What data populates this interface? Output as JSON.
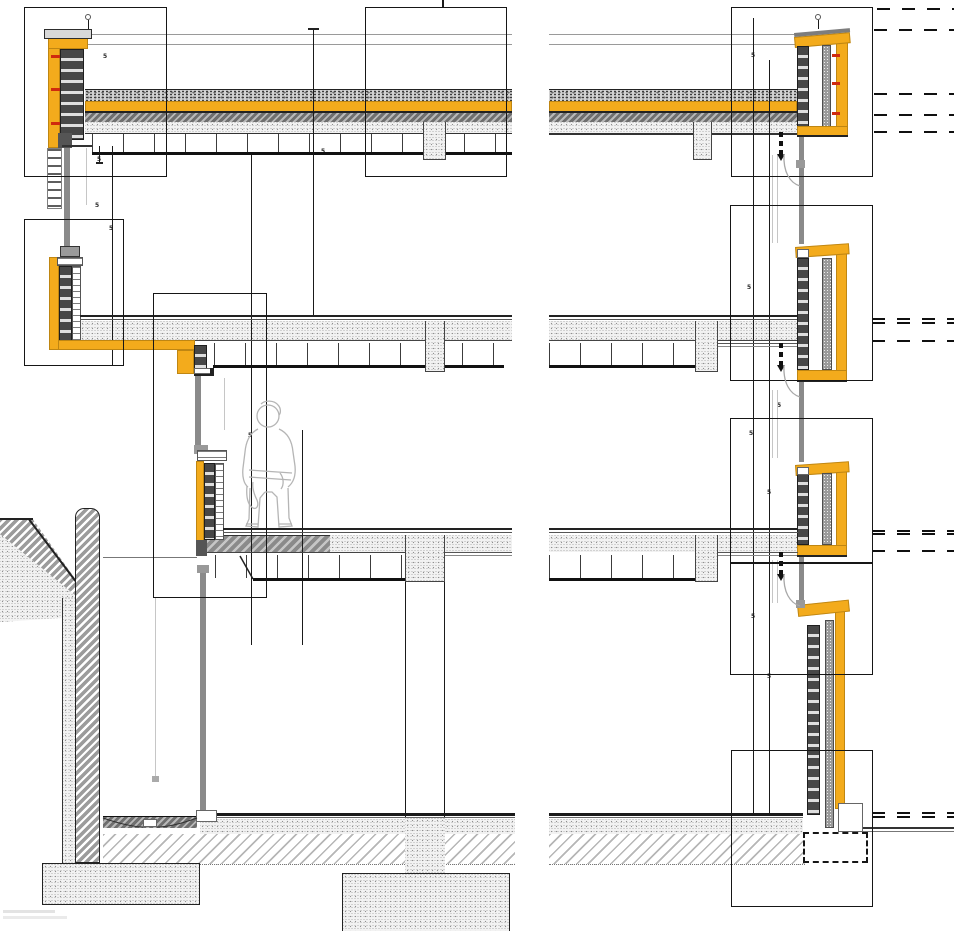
{
  "document": {
    "type": "architectural-facade-section-detail-drawing",
    "description": "Multi-storey building wall section with roof parapets, facade spandrel details, suspended ceilings, basement retaining wall and foundations; detail callout boxes and break lines",
    "background": "#ffffff"
  },
  "colors": {
    "insulation_yellow": "#F3AB1C",
    "masonry_dark": "#474747",
    "concrete_stipple": "#f2f2f2",
    "gravel_gray": "#d2d2d2",
    "wall_hatch_gray": "#9c9c9c",
    "mullion_gray": "#8a8a8a",
    "glass_light": "#c6c6c6",
    "wall_tie_red": "#cf2a0e",
    "line_black": "#1a1a1a"
  },
  "components": {
    "left": [
      "roof-parapet-detail",
      "terrace-parapet-detail",
      "level3-sill-wall",
      "canopy-and-retaining-wall",
      "strip-footing"
    ],
    "right": [
      "roof-parapet-detail",
      "spandrel-detail-level2",
      "spandrel-detail-level3",
      "base-wall-detail",
      "foundation-dashed"
    ],
    "slabs": [
      "roof-slab",
      "level2-slab",
      "level3-slab",
      "ground-slab"
    ],
    "figure": "human-scale-figure"
  },
  "annotations": {
    "dimension_marks": [
      {
        "x": 103,
        "y": 54,
        "text": "5"
      },
      {
        "x": 97,
        "y": 157,
        "text": "5"
      },
      {
        "x": 95,
        "y": 203,
        "text": "5"
      },
      {
        "x": 109,
        "y": 226,
        "text": "5"
      },
      {
        "x": 321,
        "y": 149,
        "text": "5"
      },
      {
        "x": 248,
        "y": 433,
        "text": "5"
      },
      {
        "x": 297,
        "y": 336,
        "text": "5"
      },
      {
        "x": 751,
        "y": 53,
        "text": "5"
      },
      {
        "x": 747,
        "y": 285,
        "text": "5"
      },
      {
        "x": 749,
        "y": 431,
        "text": "5"
      },
      {
        "x": 767,
        "y": 490,
        "text": "5"
      },
      {
        "x": 751,
        "y": 614,
        "text": "5"
      },
      {
        "x": 767,
        "y": 674,
        "text": "5"
      },
      {
        "x": 777,
        "y": 403,
        "text": "5"
      },
      {
        "x": 319,
        "y": 114,
        "text": "5"
      }
    ]
  }
}
